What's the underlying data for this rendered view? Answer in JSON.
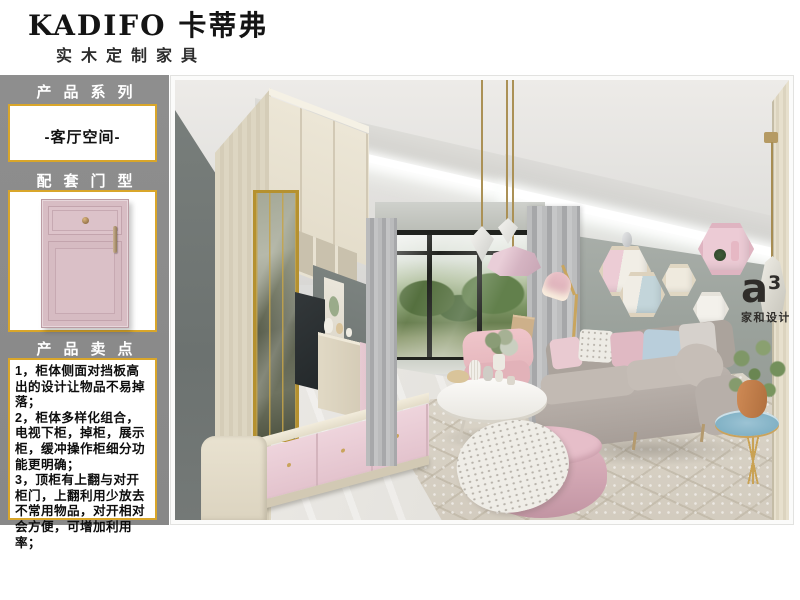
{
  "header": {
    "brand": "KADIFO 卡蒂弗",
    "tagline": "实木定制家具"
  },
  "sidebar": {
    "series_title": "产品系列",
    "series_value": "-客厅空间-",
    "door_title": "配套门型",
    "sellpoints_title": "产品卖点",
    "sellpoints": [
      "1，柜体侧面对挡板高出的设计让物品不易掉落；",
      "2，柜体多样化组合，电视下柜，掉柜，展示柜，缓冲操作柜细分功能更明确；",
      "3，顶柜有上翻与对开柜门，上翻利用少放去不常用物品，对开相对会方便，可增加利用率；"
    ]
  },
  "photo": {
    "watermark_logo": "a",
    "watermark_sup": "3",
    "watermark_name": "家和设计"
  },
  "colors": {
    "accent_gold": "#d9a62a",
    "sidebar_gray": "#8a8a8a",
    "door_pink": "#d8bdc4",
    "wall_gray": "#99a09b"
  }
}
